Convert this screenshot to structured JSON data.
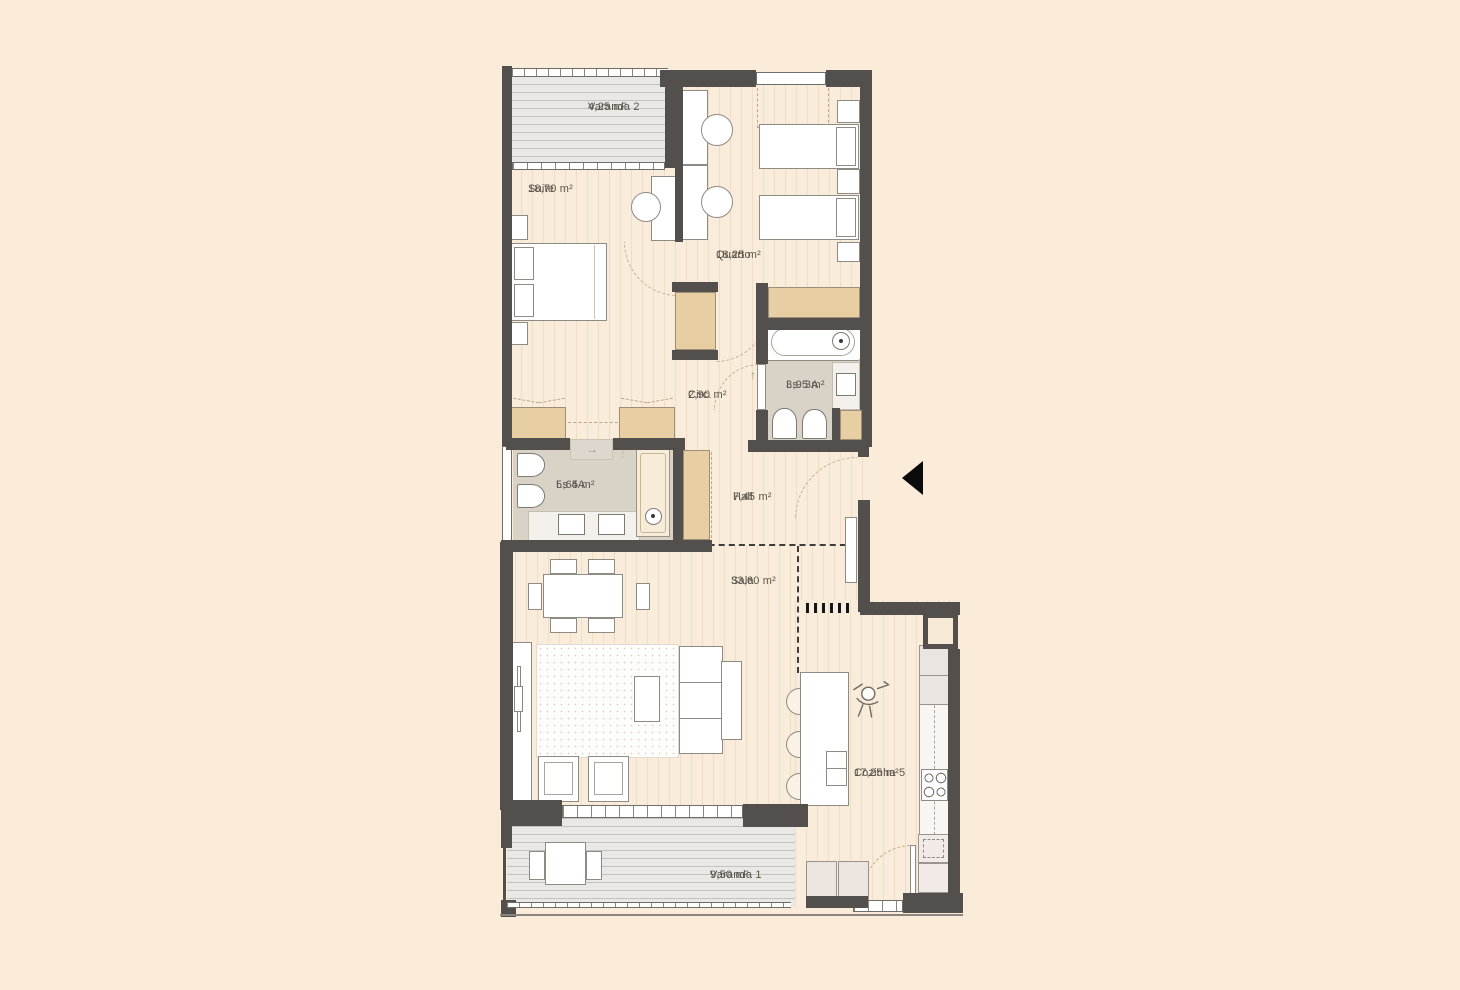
{
  "drawing": {
    "type": "apartment-floor-plan",
    "language": "pt",
    "palette": {
      "background": "#faecd8",
      "walls": "#524f4c",
      "interior_floor": "#f9ecda",
      "balcony_floor": "#e9e8e5",
      "bathroom_floor": "#d8d2c7",
      "wardrobe": "#e8cfa3",
      "label_text": "#59544c",
      "entrance_marker": "#0b0b0b"
    }
  },
  "rooms": [
    {
      "id": "varanda2",
      "name": "Varanda 2",
      "area": "4,25 m²"
    },
    {
      "id": "suite",
      "name": "Suite",
      "area": "18,70 m²"
    },
    {
      "id": "quarto",
      "name": "Quarto",
      "area": "18,25 m²"
    },
    {
      "id": "is3a",
      "name": "I.s.  3A",
      "area": "3,95 m²"
    },
    {
      "id": "circ",
      "name": "Circ.",
      "area": "2,90 m²"
    },
    {
      "id": "is4a",
      "name": "I.s  4A",
      "area": "5,65 m²"
    },
    {
      "id": "hall",
      "name": "Hall",
      "area": "7,45 m²"
    },
    {
      "id": "sala",
      "name": "Sala",
      "area": "33,60 m²"
    },
    {
      "id": "cozinha",
      "name": "Cozinha 5",
      "area": "17,25 m²"
    },
    {
      "id": "varanda1",
      "name": "Varanda 1",
      "area": "9,50 m²"
    }
  ],
  "symbols": {
    "entry_arrow_icon": "entrance-triangle-left",
    "mat_arrow": "→",
    "door_arrow": "↑"
  }
}
